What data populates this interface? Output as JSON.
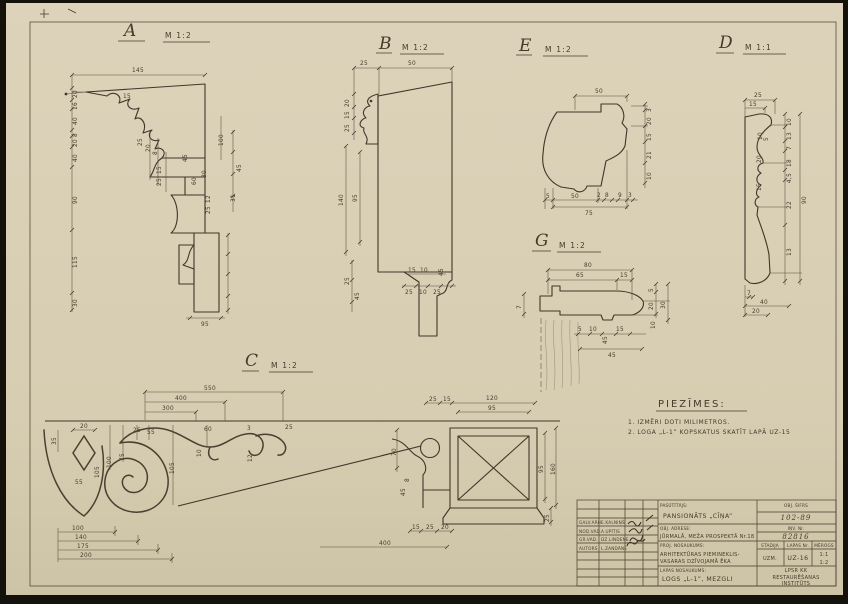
{
  "sections": {
    "a": {
      "letter": "A",
      "scale": "M 1:2",
      "dims": [
        "145",
        "20",
        "16",
        "40",
        "8",
        "20",
        "40",
        "90",
        "115",
        "30",
        "15",
        "25",
        "20",
        "8",
        "100",
        "45",
        "15",
        "25",
        "60",
        "80",
        "45",
        "31",
        "12",
        "25",
        "95"
      ]
    },
    "b": {
      "letter": "B",
      "scale": "M 1:2",
      "dims": [
        "25",
        "50",
        "20",
        "15",
        "25",
        "140",
        "95",
        "25",
        "45",
        "15",
        "10",
        "45",
        "25",
        "10",
        "25"
      ]
    },
    "e": {
      "letter": "E",
      "scale": "M 1:2",
      "dims": [
        "50",
        "3",
        "20",
        "15",
        "21",
        "10",
        "5",
        "50",
        "2",
        "8",
        "9",
        "3",
        "75"
      ]
    },
    "d": {
      "letter": "D",
      "scale": "M 1:1",
      "dims": [
        "25",
        "15",
        "10",
        "13",
        "7",
        "18",
        "4,5",
        "22",
        "13",
        "90",
        "7",
        "40",
        "20",
        "10",
        "5",
        "20",
        "15"
      ]
    },
    "g": {
      "letter": "G",
      "scale": "M 1:2",
      "dims": [
        "80",
        "65",
        "15",
        "5",
        "20",
        "30",
        "10",
        "7",
        "5",
        "10",
        "45",
        "15",
        "45"
      ]
    },
    "c": {
      "letter": "C",
      "scale": "M 1:2",
      "dims": [
        "550",
        "400",
        "300",
        "20",
        "35",
        "55",
        "105",
        "100",
        "75",
        "25",
        "55",
        "105",
        "60",
        "10",
        "3",
        "12",
        "25",
        "100",
        "140",
        "175",
        "200",
        "400",
        "25",
        "15",
        "120",
        "95",
        "70",
        "8",
        "45",
        "95",
        "160",
        "25",
        "15",
        "25",
        "20"
      ]
    }
  },
  "notes": {
    "title": "PIEZĪMES:",
    "line1": "1. IZMĒRI DOTI MILIMETROS.",
    "line2": "2. LOGA „L-1” KOPSKATUS SKATĪT LAPĀ UZ-15"
  },
  "titleblock": {
    "rows": [
      {
        "role": "GALV.ARH.",
        "name": "E.KALNIŅŠ"
      },
      {
        "role": "NOD.VAD.",
        "name": "A.UPĪTIS"
      },
      {
        "role": "GR.VAD.",
        "name": "DZ.LINDENE"
      },
      {
        "role": "AUTORS",
        "name": "L.ZANDĀNE"
      }
    ],
    "client_label": "PASŪTĪTĀJS:",
    "client": "PANSIONĀTS „CĪŅA”",
    "address_label": "OBJ. ADRESE:",
    "address": "JŪRMALĀ, MEŽA PROSPEKTĀ Nr.18",
    "project_label": "PROJ. NOSAUKUMS:",
    "project1": "ARHITEKTŪRAS PIEMINEKLIS-",
    "project2": "VASARAS DZĪVOJAMĀ ĒKA",
    "sheet_label": "LAPAS NOSAUKUMS:",
    "sheet": "LOGS „L-1”, MEZGLI",
    "code_label": "OBJ. ŠIFRS",
    "code": "102-89",
    "inv_label": "INV. Nr.",
    "inv": "82816",
    "stage_label": "STADIJA",
    "stage": "UZM.",
    "sheetno_label": "LAPAS Nr.",
    "sheetno": "UZ-16",
    "scale_label": "MĒROGS",
    "scale1": "1:1",
    "scale2": "1:2",
    "org1": "LPSR KK",
    "org2": "RESTAURĒŠANAS",
    "org3": "INSTITŪTS"
  }
}
